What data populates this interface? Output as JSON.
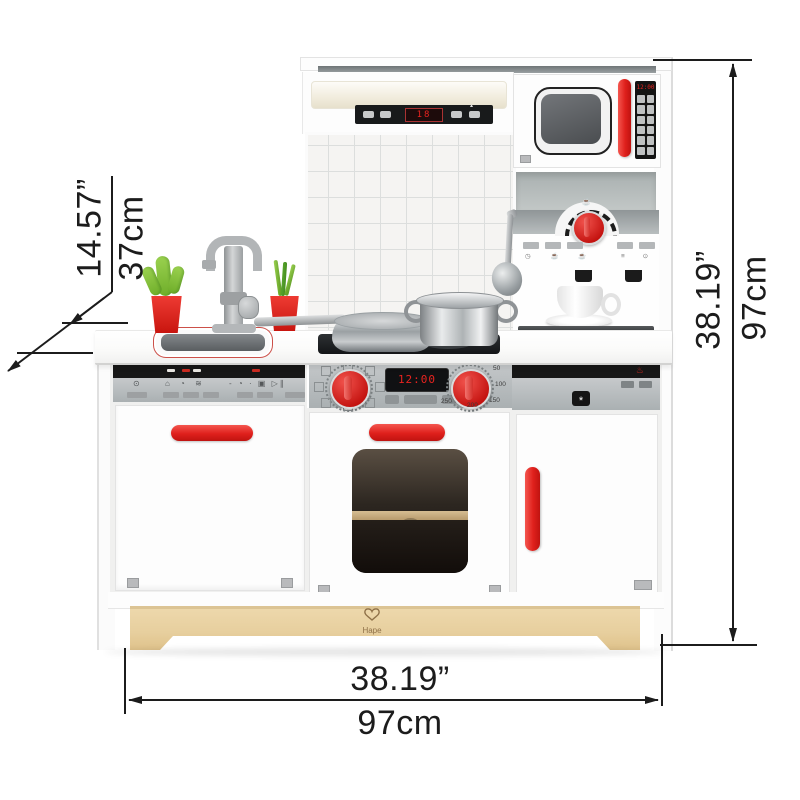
{
  "brand": "Hape",
  "dimensions": {
    "depth_in": "14.57”",
    "depth_cm": "37cm",
    "height_in": "38.19”",
    "height_cm": "97cm",
    "width_in": "38.19”",
    "width_cm": "97cm"
  },
  "appliances": {
    "hood": {
      "display": "18",
      "fan_icon": "▴"
    },
    "microwave": {
      "display": "12:00"
    },
    "oven": {
      "display": "12:00",
      "temps": [
        "50",
        "100",
        "150",
        "200",
        "250"
      ]
    },
    "dishwasher": {
      "power_icon": "⊙",
      "mode_icons": "⌂ ◔ ≋",
      "option_icons": "- ◔ · ▣  ▷∥"
    },
    "coffee_machine": {
      "cup_icon": "☕",
      "left_icons": "◷ ☕ ☕",
      "right_icons": "≡ ⊙"
    },
    "side_cabinet": {
      "freeze_icon": "*",
      "alert_icon": "♨"
    }
  },
  "colors": {
    "accent_red": "#df201c",
    "wood_light": "#eed9ad",
    "wood_dark": "#dfc28b",
    "panel_gray": "#b7babc",
    "strip_black": "#171717",
    "line_black": "#1c1c1c"
  }
}
